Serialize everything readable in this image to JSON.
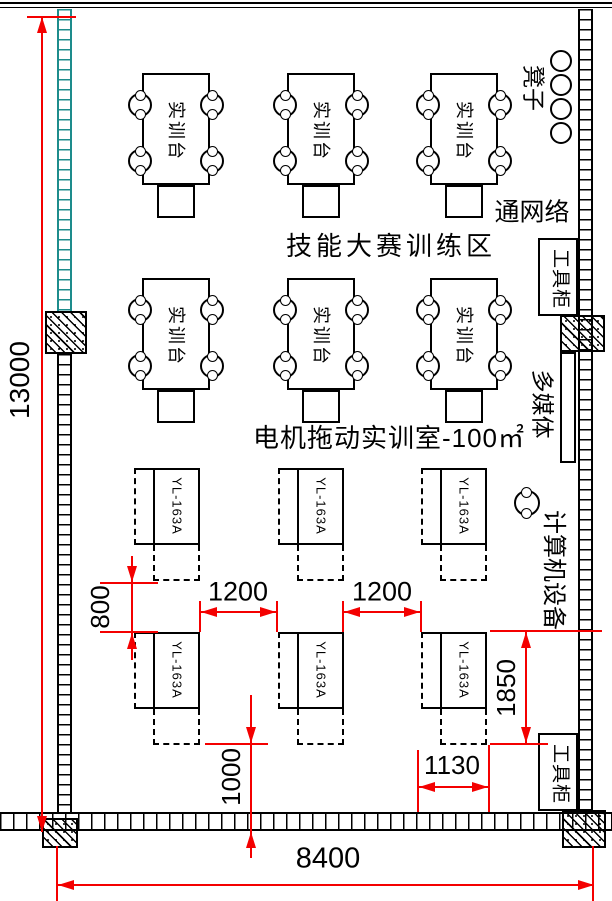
{
  "labels": {
    "training_area": "技能大赛训练区",
    "room": "电机拖动实训室-100㎡",
    "workbench": "实训台",
    "yl_bench": "YL-163A",
    "stools": "凳子",
    "network": "通网络",
    "tool_cabinet": "工具柜",
    "multimedia": "多媒体",
    "computer_equipment": "计算机设备"
  },
  "dimensions": {
    "room_height": "13000",
    "room_width": "8400",
    "bench_row_gap": "800",
    "aisle_left": "1200",
    "aisle_right": "1200",
    "bottom_clearance": "1000",
    "bench_zone_depth": "1850",
    "bench_width": "1130"
  },
  "colors": {
    "dimension_lines": "#f40000",
    "window_wall": "#1d8c8c",
    "drawing_lines": "#000000"
  }
}
